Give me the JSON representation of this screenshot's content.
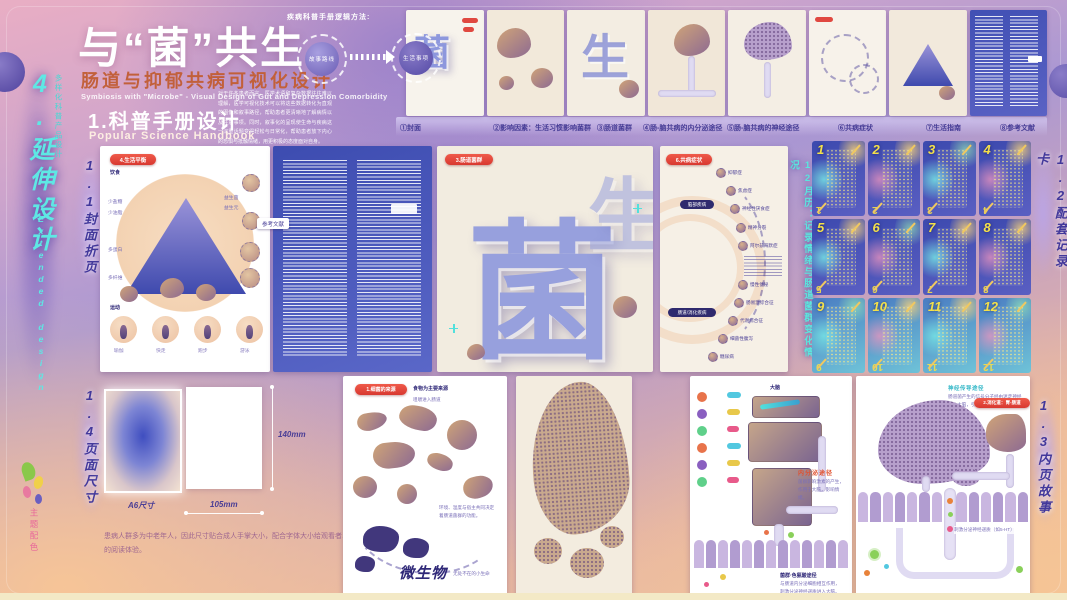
{
  "strip_left": {
    "title": "4.延伸设计",
    "note": "多样化科普产品设计",
    "en": "Extended design",
    "palette": "主题配色"
  },
  "strip_right": {
    "cards_label": "1.2配套记录卡",
    "story_label": "1.3内页故事"
  },
  "header": {
    "title": "与“菌”共生",
    "subtitle": "肠道与抑郁共病可视化设计",
    "subtitle_en": "Symbiosis with \"Microbe\" - Visual Design of Gut and Depression Comorbidity",
    "section": "1.科普手册设计",
    "section_en": "Popular Science Handbook",
    "intro": "对于许多患者而言，医学术语和复杂数据往往难以理解，医学可视化技术可以将这些数据转化为直观的图像和叙事路径，帮助患者更清晰地了解病情以及注意事项。同时，叙事化的呈现使生命与疾病这一沉重话题变得轻松与日常化，帮助患者放下内心的恐惧与抵触情绪，用更积极的态度面对自身。"
  },
  "flow": {
    "label": "疾病科普手册逻辑方法:",
    "node1": "故事路线",
    "node2": "生活事项"
  },
  "captions": {
    "c1": "①封面",
    "c2": "②影响因素：生活习惯影响菌群",
    "c3": "③肠道菌群",
    "c4": "④肠-脑共病的内分泌途径",
    "c5": "⑤肠-脑共病的神经途径",
    "c6": "⑥共病症状",
    "c7": "⑦生活指南",
    "c8": "⑧参考文献"
  },
  "sections": {
    "s11": "1.1封面折页",
    "s14": "1.4页面尺寸",
    "cal_note": "12月历：记录情绪与肠道菌群变化情况"
  },
  "cover_page": {
    "badge": "4.生活平衡",
    "diet": "饮食",
    "l1": "少盐糖",
    "l2": "少油脂",
    "l3": "多蛋白",
    "l4": "多纤维",
    "r1": "益生菌",
    "r2": "益生元",
    "sport": "运动",
    "sp1": "瑜伽",
    "sp2": "快走",
    "sp3": "跑步",
    "sp4": "游泳"
  },
  "ref_page": {
    "tag": "参考文献"
  },
  "art_page": {
    "badge": "3.肠道菌群",
    "glyph1": "菌",
    "glyph2": "生"
  },
  "disease_page": {
    "badge": "6.共病症状",
    "cat_brain": "脑部疾病",
    "cat_gut": "肠道/消化疾病",
    "d1": "抑郁症",
    "d2": "焦虑症",
    "d3": "神经性厌食症",
    "d4": "精神分裂",
    "d5": "阿尔兹海默症",
    "d6": "慢性便秘",
    "d7": "肠易激综合征",
    "d8": "代谢综合征",
    "d9": "细菌性腹泻",
    "d10": "糖尿病"
  },
  "cards": {
    "n1": "1",
    "n2": "2",
    "n3": "3",
    "n4": "4",
    "n5": "5",
    "n6": "6",
    "n7": "7",
    "n8": "8",
    "n9": "9",
    "n10": "10",
    "n11": "11",
    "n12": "12"
  },
  "size_section": {
    "a6": "A6尺寸",
    "w": "105mm",
    "h": "140mm",
    "note": "患病人群多为中老年人，因此尺寸贴合成人手掌大小，配合字体大小给观看者以舒适的阅读体验。"
  },
  "microbe_page": {
    "badge": "1.细菌的来源",
    "t1": "食物为主要来源",
    "t2": "咀嚼进入肠道",
    "note": "环境、温度与宿主共同决定着肠道菌群的功能。",
    "title": "微生物",
    "sub": "无处不在的小生命"
  },
  "endocrine_page": {
    "brain": "大脑",
    "path": "内分泌途径",
    "path_note": "菌群影响激素的产生，作用于大脑，影响情绪。",
    "bottom": "菌群·色氨酸途径",
    "bottom_note": "与肠道内分泌细胞相互作用，刺激分泌神经递质进入大脑。"
  },
  "neural_page": {
    "badge": "2.消化道：胃-肠道",
    "heading": "神经传导途径",
    "note": "肠道菌产生的信号分子经由迷走神经进入大脑，引起情绪与压力反应。",
    "villi_note": "刺激分泌神经递质（如5-HT）"
  }
}
